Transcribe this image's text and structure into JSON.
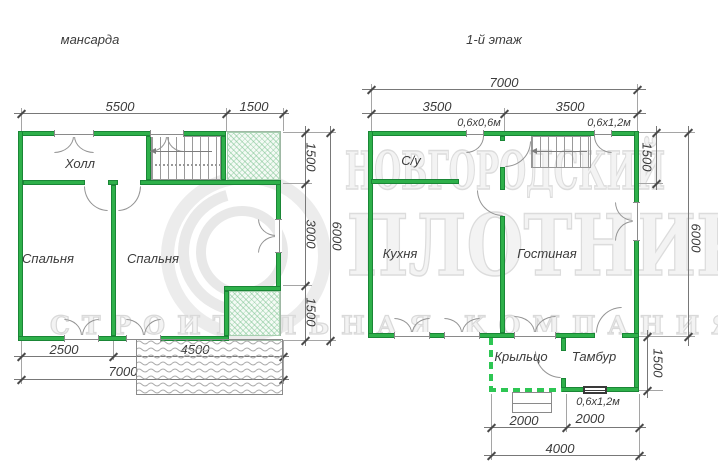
{
  "colors": {
    "wall": "#2eb04a",
    "wall_edge": "#1a8636",
    "dash_green": "#2dc653",
    "dim_line": "#787878",
    "text": "#3c3c3c",
    "watermark": "#e7e7e7"
  },
  "plans": {
    "mansarda": {
      "title": "мансарда",
      "rooms": {
        "hall": "Холл",
        "bedroom_left": "Спальня",
        "bedroom_right": "Спальня"
      },
      "dims": {
        "top_main": "5500",
        "top_right": "1500",
        "right_upper": "1500",
        "right_middle": "3000",
        "right_lower": "1500",
        "right_total": "6000",
        "bottom_left": "2500",
        "bottom_right": "4500",
        "bottom_total": "7000"
      }
    },
    "first_floor": {
      "title": "1-й этаж",
      "rooms": {
        "bathroom": "С/у",
        "kitchen": "Кухня",
        "living": "Гостиная",
        "porch": "Крыльцо",
        "tambour": "Тамбур"
      },
      "window_labels": {
        "top_small": "0,6х0,6м",
        "top_large": "0,6х1,2м",
        "tambour": "0,6х1,2м"
      },
      "dims": {
        "top_total": "7000",
        "top_left": "3500",
        "top_right": "3500",
        "right_upper": "1500",
        "right_total": "6000",
        "tambour_right": "1500",
        "bottom_left": "2000",
        "bottom_right": "2000",
        "bottom_total": "4000"
      }
    }
  },
  "watermark": {
    "line1": "НОВГОРОДСКИЙ",
    "line2": "ПЛОТНИК",
    "banner": "СТРОИТЕЛЬНАЯ КОМПАНИЯ"
  }
}
